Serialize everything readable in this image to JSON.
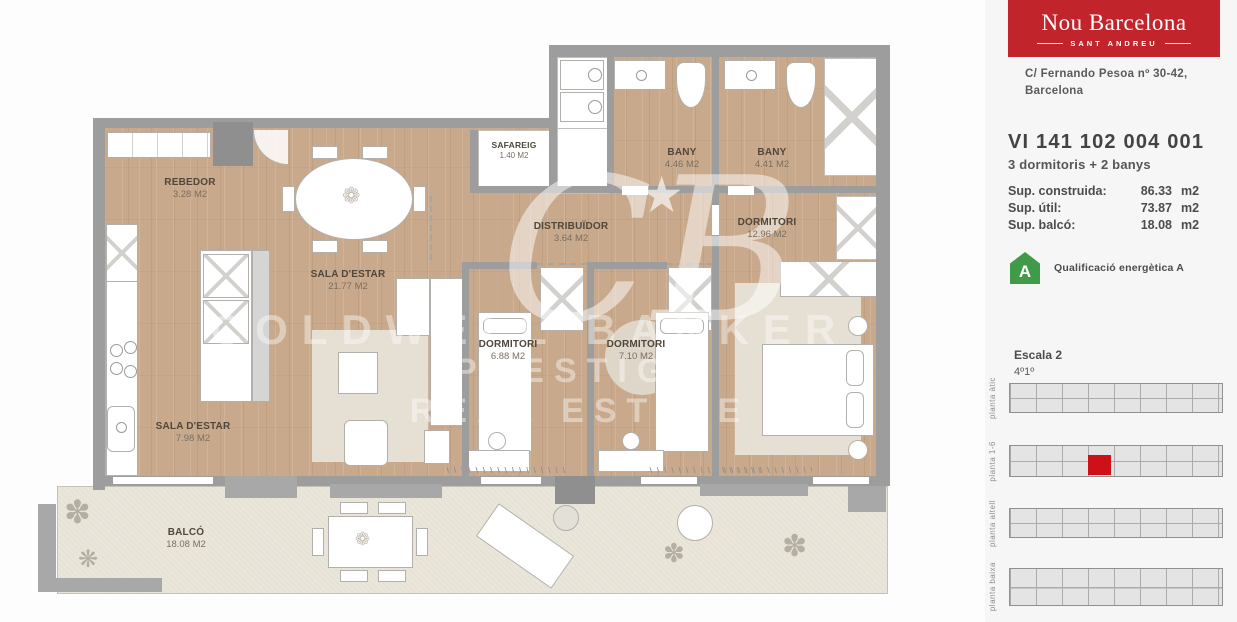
{
  "floorplan": {
    "rooms": [
      {
        "name": "REBEDOR",
        "area": "3.28 M2"
      },
      {
        "name": "SALA D'ESTAR",
        "area": "21.77 M2"
      },
      {
        "name": "SAFAREIG",
        "area": "1.40 M2"
      },
      {
        "name": "BANY",
        "area": "4.46 M2"
      },
      {
        "name": "BANY",
        "area": "4.41 M2"
      },
      {
        "name": "DISTRIBUÏDOR",
        "area": "3.64 M2"
      },
      {
        "name": "DORMITORI",
        "area": "12.96 M2"
      },
      {
        "name": "DORMITORI",
        "area": "6.88 M2"
      },
      {
        "name": "DORMITORI",
        "area": "7.10 M2"
      },
      {
        "name": "SALA D'ESTAR",
        "area": "7.98 M2"
      },
      {
        "name": "BALCÓ",
        "area": "18.08 M2"
      }
    ],
    "watermark": {
      "monogram": "CB",
      "star": "★",
      "line1": "COLDWELL BANKER",
      "line2": "PRESTIGE",
      "line3": "REAL ESTATE"
    },
    "colors": {
      "wood": "#c9a98b",
      "wall": "#9d9d9d",
      "balcony": "#ebe6da"
    }
  },
  "sidebar": {
    "brand": {
      "title": "Nou Barcelona",
      "subtitle": "SANT ANDREU",
      "bg": "#c2242c"
    },
    "address": {
      "line1": "C/ Fernando Pesoa nº 30-42,",
      "line2": "Barcelona"
    },
    "unit": {
      "code": "VI 141 102 004 001",
      "layout": "3 dormitoris + 2 banys"
    },
    "surfaces": [
      {
        "label": "Sup. construida:",
        "value": "86.33",
        "unit": "m2"
      },
      {
        "label": "Sup. útil:",
        "value": "73.87",
        "unit": "m2"
      },
      {
        "label": "Sup. balcó:",
        "value": "18.08",
        "unit": "m2"
      }
    ],
    "energy": {
      "rating": "A",
      "label": "Qualificació energètica A",
      "color": "#3f9b48"
    },
    "location": {
      "staircase": "Escala 2",
      "floor_door": "4º1º"
    },
    "building_levels": [
      {
        "label": "planta àtic",
        "highlight": false
      },
      {
        "label": "planta 1-6",
        "highlight": true
      },
      {
        "label": "planta altell",
        "highlight": false
      },
      {
        "label": "planta baixa",
        "highlight": false
      }
    ],
    "unit_highlight_color": "#ce1118"
  }
}
